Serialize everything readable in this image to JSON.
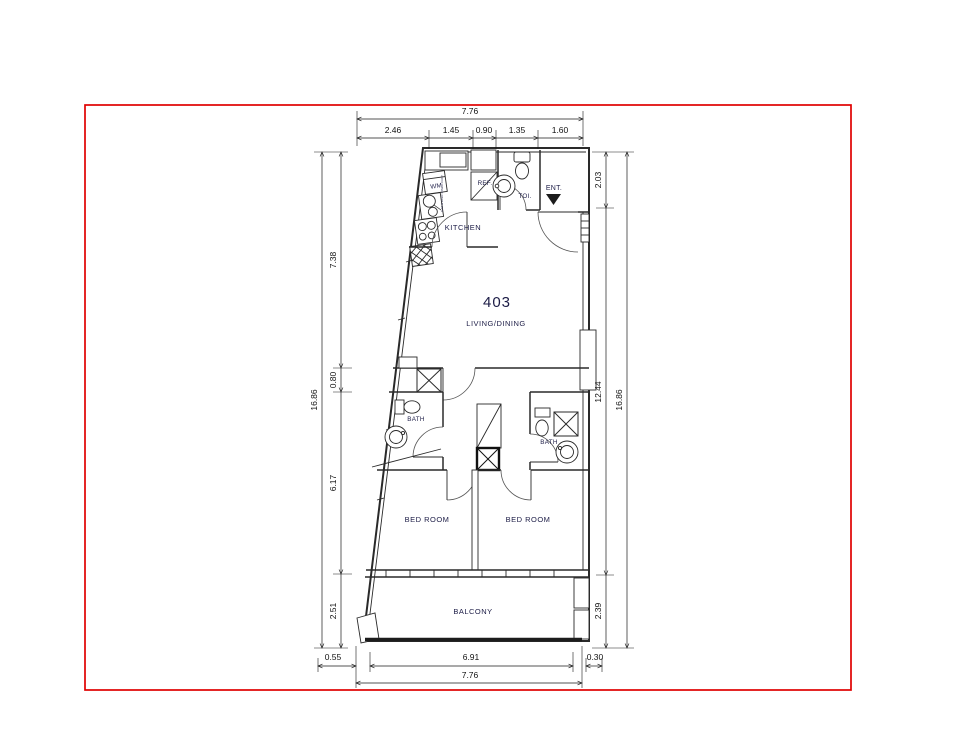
{
  "page": {
    "background": "#ffffff",
    "border_color": "#e00000",
    "line_color": "#2a2a2a",
    "label_color": "#1c1c46"
  },
  "floorplan": {
    "unit_number": "403",
    "rooms": {
      "living": "LIVING/DINING",
      "kitchen": "KITCHEN",
      "toilet": "TOI.",
      "entrance": "ENT.",
      "refrigerator": "REF.",
      "washing_machine": "WM",
      "bath_left": "BATH",
      "bath_right": "BATH",
      "bedroom_left": "BED ROOM",
      "bedroom_right": "BED ROOM",
      "balcony": "BALCONY",
      "riser_note": "GAS & ELEC RISER DUCT"
    },
    "dimensions": {
      "top_total": "7.76",
      "top_segments": [
        "2.46",
        "1.45",
        "0.90",
        "1.35",
        "1.60"
      ],
      "left_total": "16.86",
      "left_segments": [
        "7.38",
        "0.80",
        "6.17",
        "2.51"
      ],
      "right_total": "16.86",
      "right_segments": [
        "2.03",
        "12.44",
        "2.39"
      ],
      "bottom_left_offset": "0.55",
      "bottom_inner": "6.91",
      "bottom_right_offset": "0.30",
      "bottom_total": "7.76"
    }
  }
}
